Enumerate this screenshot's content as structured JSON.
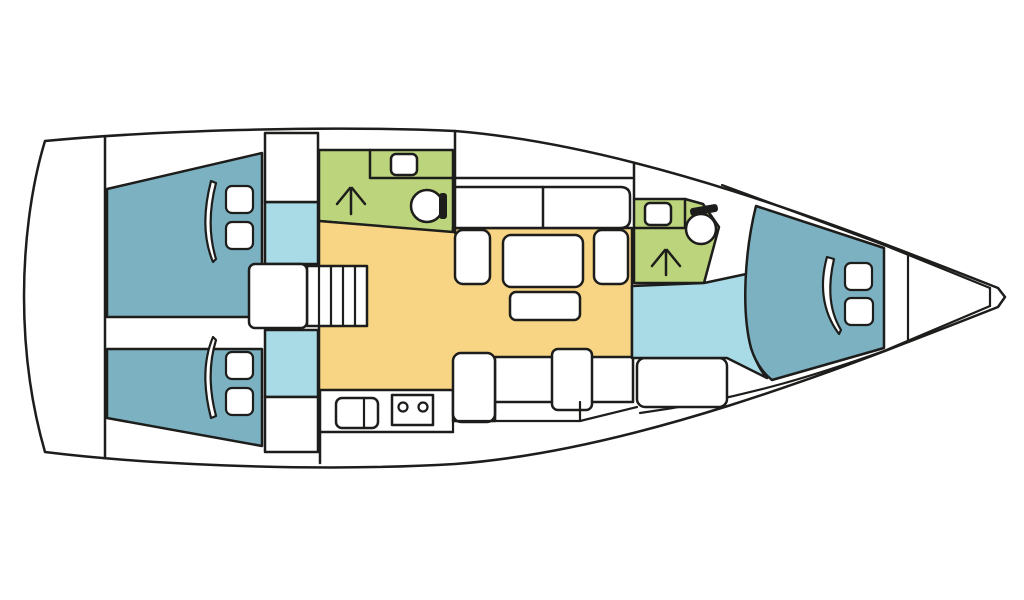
{
  "diagram": {
    "type": "floor-plan",
    "subject": "Sailing yacht interior layout, top-down deck plan",
    "orientation": {
      "bow": "right",
      "stern": "left"
    },
    "colors": {
      "outline": "#1d1d1b",
      "hull": "#ffffff",
      "cabin": "#7bb1c1",
      "corridor": "#a9dbe7",
      "head": "#bcd47c",
      "salon": "#f8d485",
      "furniture": "#ffffff",
      "fixture_dark": "#1d1d1b"
    },
    "rooms": [
      {
        "id": "aft-cabin-port",
        "label": "Aft double cabin (port)",
        "color": "cabin",
        "features": [
          "double berth",
          "2 pillows",
          "folded blanket"
        ]
      },
      {
        "id": "aft-cabin-starboard",
        "label": "Aft double cabin (starboard)",
        "color": "cabin",
        "features": [
          "double berth",
          "2 pillows",
          "folded blanket"
        ]
      },
      {
        "id": "aft-head",
        "label": "Aft head with shower",
        "color": "head",
        "features": [
          "toilet",
          "washbasin",
          "shower"
        ]
      },
      {
        "id": "salon",
        "label": "Salon / dinette",
        "color": "salon",
        "features": [
          "table",
          "settee",
          "2 side seats",
          "bench"
        ]
      },
      {
        "id": "galley",
        "label": "Galley",
        "color": "furniture",
        "features": [
          "twin sink",
          "2-burner stove",
          "counter"
        ]
      },
      {
        "id": "companionway",
        "label": "Companionway stairs",
        "color": "furniture",
        "features": [
          "landing",
          "5 steps"
        ]
      },
      {
        "id": "forward-head",
        "label": "Forward head with shower",
        "color": "head",
        "features": [
          "toilet",
          "washbasin",
          "shower"
        ]
      },
      {
        "id": "forward-corridor",
        "label": "Forward passage",
        "color": "corridor",
        "features": []
      },
      {
        "id": "forward-cabin",
        "label": "Forward V-berth cabin",
        "color": "cabin",
        "features": [
          "double berth",
          "2 pillows",
          "folded blanket"
        ]
      },
      {
        "id": "anchor-locker",
        "label": "Bow anchor locker",
        "color": "hull",
        "features": []
      }
    ],
    "counts": {
      "cabins": 3,
      "heads": 2,
      "tables": 1,
      "companionway_steps": 5
    }
  }
}
